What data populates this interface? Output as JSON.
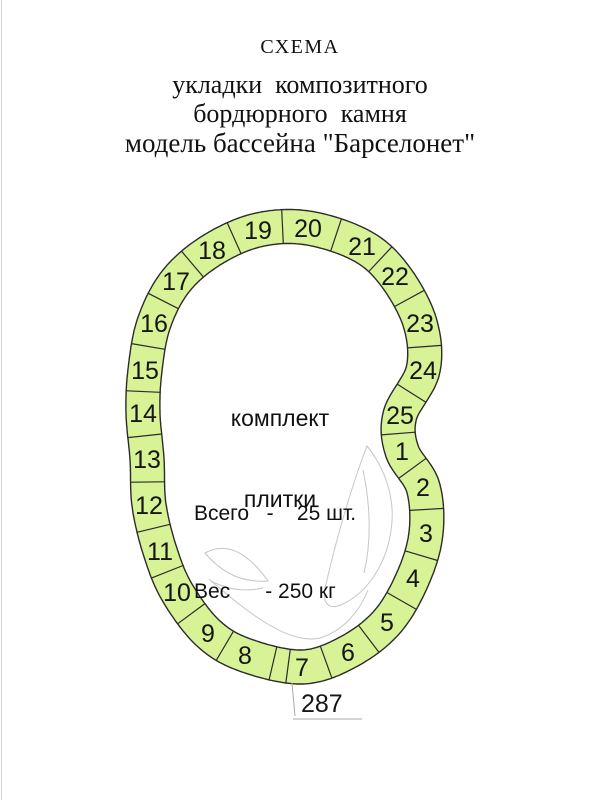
{
  "header": {
    "title": "СХЕМА",
    "subtitle_lines": [
      "укладки  композитного",
      "бордюрного  камня",
      "модель бассейна \"Барселонет\""
    ]
  },
  "diagram": {
    "center_label_lines": [
      "комплект",
      "плитки"
    ],
    "info_lines": [
      "Всего   -    25 шт.",
      "Вес      - 250 кг"
    ],
    "colors": {
      "tile_fill": "#d8f296",
      "outline": "#2b2b2b",
      "decor": "#c6c6c6",
      "leader": "#a8a8a8",
      "text": "#161616"
    },
    "ring": {
      "half_width": 17,
      "segments": [
        {
          "n": "1",
          "x": 402,
          "y": 451
        },
        {
          "n": "2",
          "x": 423,
          "y": 487
        },
        {
          "n": "3",
          "x": 426,
          "y": 533
        },
        {
          "n": "4",
          "x": 413,
          "y": 578
        },
        {
          "n": "5",
          "x": 387,
          "y": 622
        },
        {
          "n": "6",
          "x": 348,
          "y": 652
        },
        {
          "n": "7",
          "x": 302,
          "y": 667
        },
        {
          "n": "8",
          "x": 245,
          "y": 655
        },
        {
          "n": "9",
          "x": 208,
          "y": 633
        },
        {
          "n": "10",
          "x": 177,
          "y": 592
        },
        {
          "n": "11",
          "x": 160,
          "y": 551
        },
        {
          "n": "12",
          "x": 149,
          "y": 505
        },
        {
          "n": "13",
          "x": 147,
          "y": 459
        },
        {
          "n": "14",
          "x": 143,
          "y": 413
        },
        {
          "n": "15",
          "x": 145,
          "y": 370
        },
        {
          "n": "16",
          "x": 154,
          "y": 323
        },
        {
          "n": "17",
          "x": 176,
          "y": 281
        },
        {
          "n": "18",
          "x": 212,
          "y": 250
        },
        {
          "n": "19",
          "x": 258,
          "y": 230
        },
        {
          "n": "20",
          "x": 308,
          "y": 228
        },
        {
          "n": "21",
          "x": 362,
          "y": 246
        },
        {
          "n": "22",
          "x": 395,
          "y": 276
        },
        {
          "n": "23",
          "x": 420,
          "y": 323
        },
        {
          "n": "24",
          "x": 423,
          "y": 370
        },
        {
          "n": "25",
          "x": 400,
          "y": 415
        }
      ],
      "extra_divider_position": 6.26
    },
    "decor_paths": [
      "M 367 446 C 353 482 337 536 326 584 C 321 603 328 611 343 604 C 368 592 386 564 391 531 C 396 499 385 468 367 446 Z",
      "M 363 470 C 370 503 372 540 364 573",
      "M 205 553 Q 236 536 268 581 Q 231 584 205 553 Z",
      "M 211 581 Q 236 594 263 588",
      "M 209 579 C 250 615 290 645 320 638 C 345 630 360 610 368 590"
    ],
    "dimension": {
      "label": "287",
      "leader_path": "M 292 683 L 295 716",
      "baseline_path": "M 293 719 L 362 719",
      "text_x": 301,
      "text_y": 712
    }
  }
}
